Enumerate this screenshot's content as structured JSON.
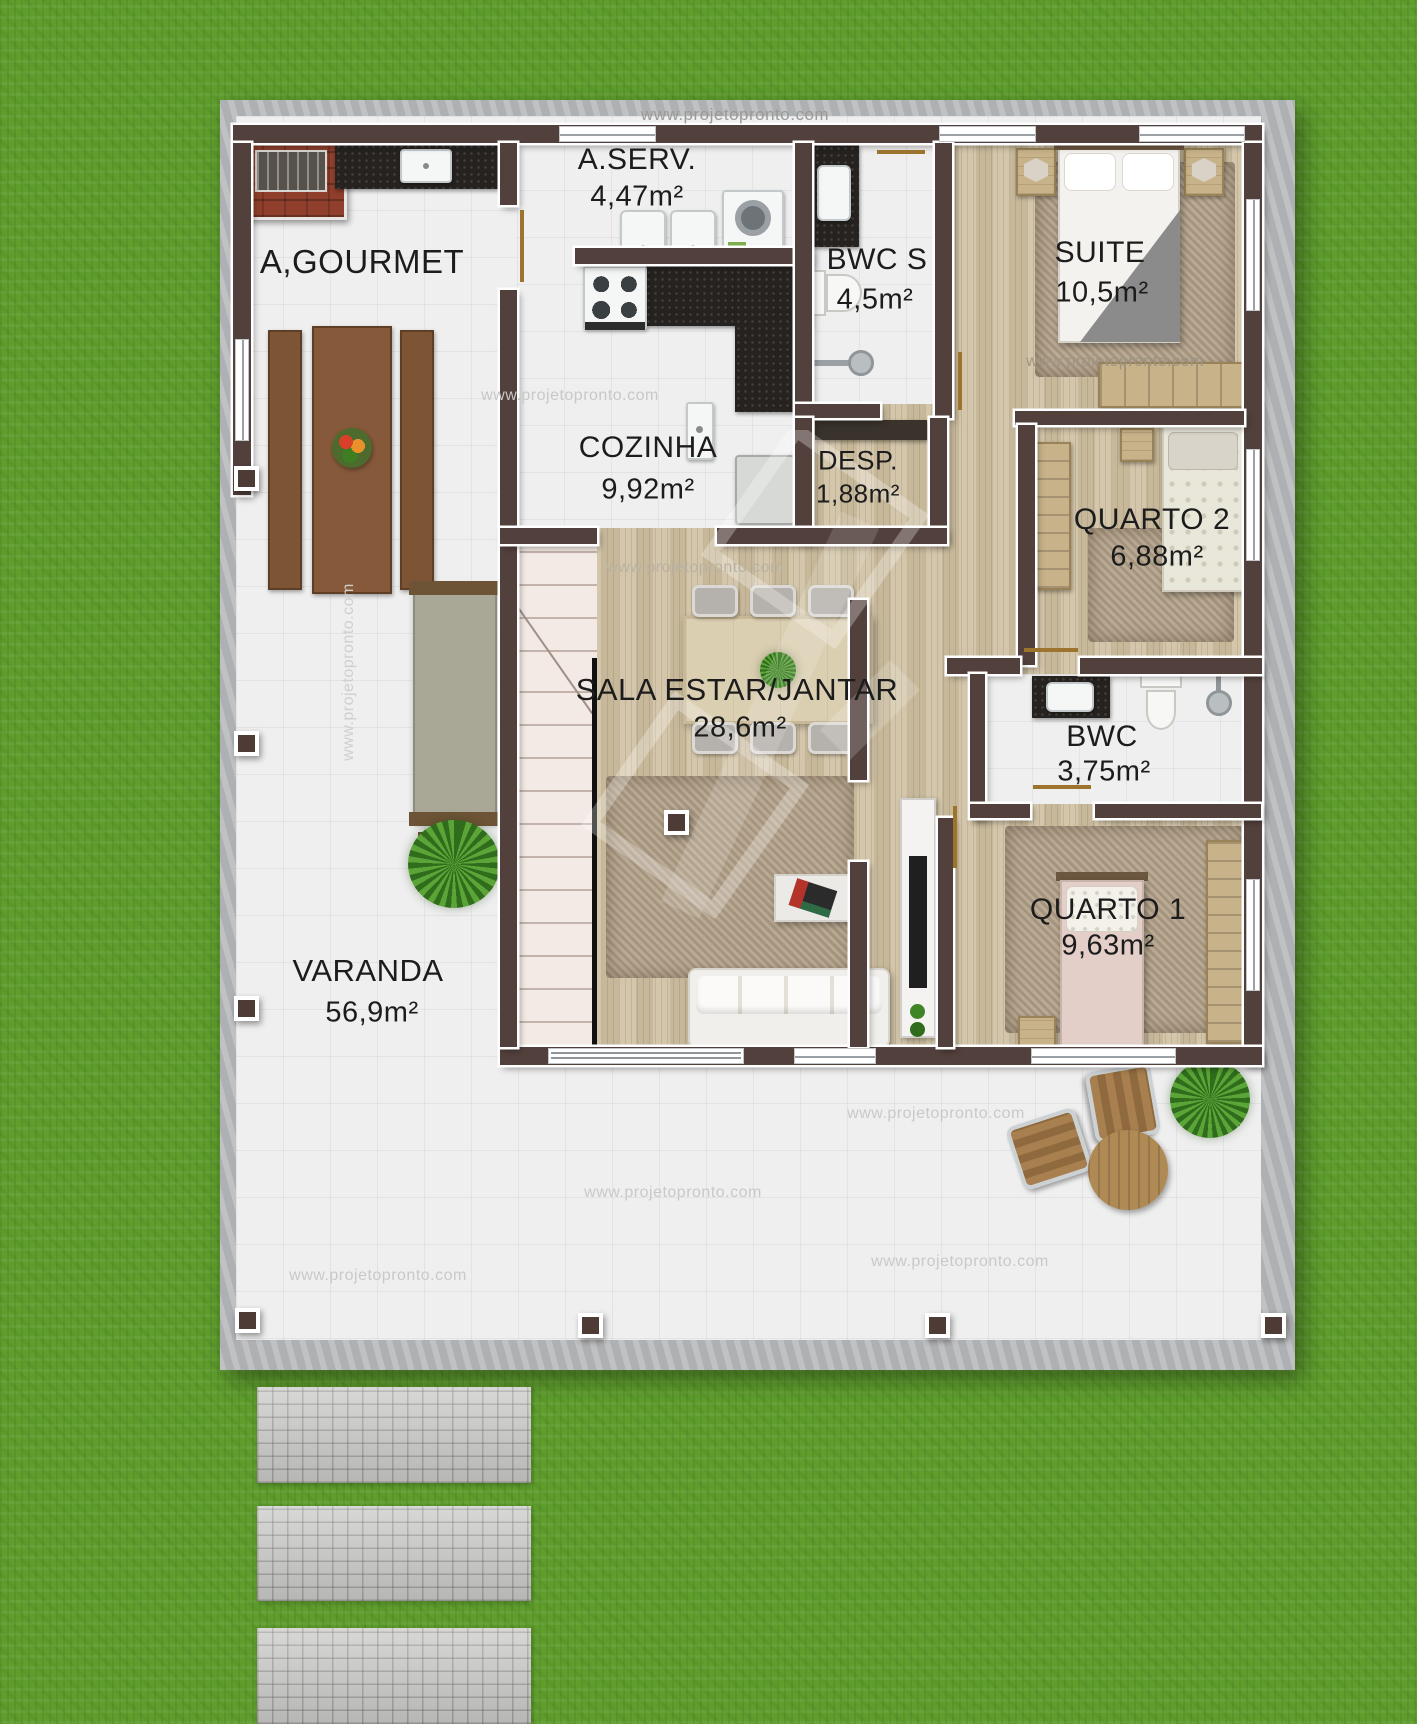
{
  "watermark": {
    "text": "www.projetopronto.com"
  },
  "rooms": [
    {
      "id": "gourmet",
      "name": "A,GOURMET",
      "area": ""
    },
    {
      "id": "aserv",
      "name": "A.SERV.",
      "area": "4,47m²"
    },
    {
      "id": "cozinha",
      "name": "COZINHA",
      "area": "9,92m²"
    },
    {
      "id": "bwcs",
      "name": "BWC S",
      "area": "4,5m²"
    },
    {
      "id": "suite",
      "name": "SUITE",
      "area": "10,5m²"
    },
    {
      "id": "desp",
      "name": "DESP.",
      "area": "1,88m²"
    },
    {
      "id": "quarto2",
      "name": "QUARTO 2",
      "area": "6,88m²"
    },
    {
      "id": "sala",
      "name": "SALA ESTAR/JANTAR",
      "area": "28,6m²"
    },
    {
      "id": "bwc",
      "name": "BWC",
      "area": "3,75m²"
    },
    {
      "id": "quarto1",
      "name": "QUARTO 1",
      "area": "9,63m²"
    },
    {
      "id": "varanda",
      "name": "VARANDA",
      "area": "56,9m²"
    }
  ],
  "fixtures": [
    "barbecue-grill",
    "counter-sink",
    "gourmet-table-with-benches",
    "fruit-platter",
    "laundry-tubs",
    "washing-machine",
    "stove",
    "refrigerator",
    "vanity-sink",
    "toilet",
    "shower",
    "double-bed",
    "single-bed",
    "nightstand",
    "table-lamp",
    "wardrobe",
    "pantry-shelf",
    "dining-table",
    "dining-chair",
    "center-plant",
    "staircase",
    "shag-rug",
    "sofa",
    "coffee-table",
    "tv-rack",
    "garden-bench",
    "potted-plant",
    "outdoor-chair",
    "outdoor-round-table",
    "support-column",
    "stepping-stones",
    "logo-watermark"
  ],
  "colors": {
    "grass": "#5f9e2d",
    "concrete": "#b8babc",
    "tile": "#efefef",
    "wall": "#52403c",
    "wood_floor": "#cfc0a0",
    "granite_counter": "#26221f",
    "brick": "#8f3f2c",
    "rug": "#b2a189",
    "label_text": "#1c1c1c",
    "watermark_gray": "#bdbdbd"
  }
}
